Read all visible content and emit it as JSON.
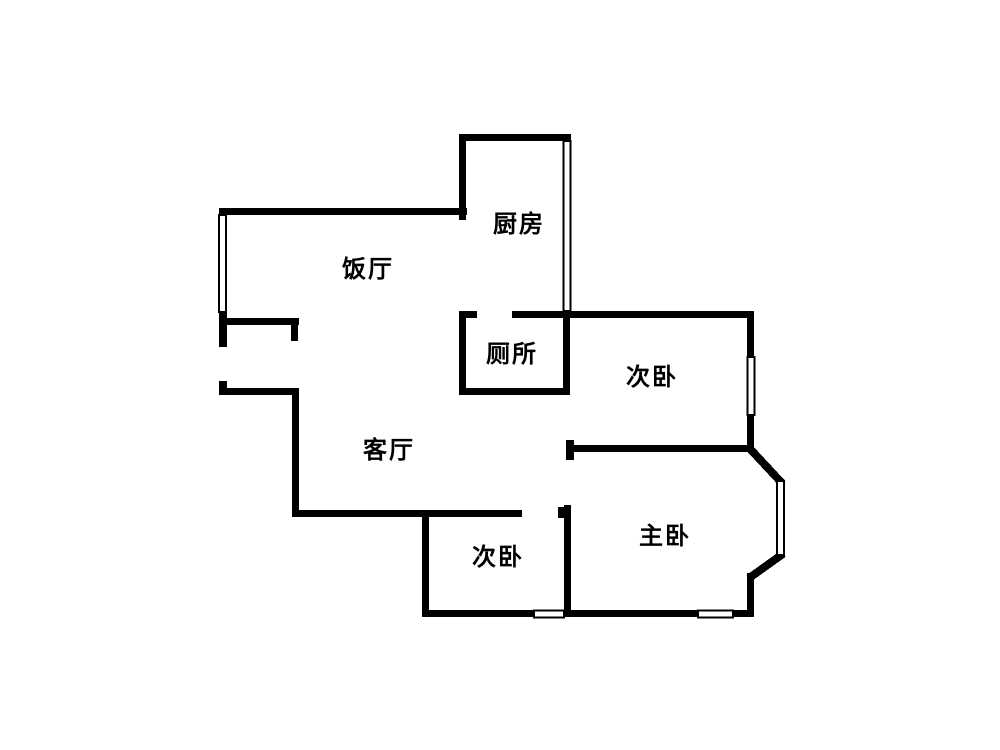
{
  "diagram": {
    "kind": "residential floor plan",
    "background_color": "#ffffff",
    "wall_color": "#000000"
  },
  "rooms": [
    {
      "id": "kitchen",
      "label": "厨房"
    },
    {
      "id": "dining",
      "label": "饭厅"
    },
    {
      "id": "toilet",
      "label": "厕所"
    },
    {
      "id": "bedroom-north",
      "label": "次卧"
    },
    {
      "id": "living",
      "label": "客厅"
    },
    {
      "id": "master-bedroom",
      "label": "主卧"
    },
    {
      "id": "bedroom-south",
      "label": "次卧"
    }
  ]
}
